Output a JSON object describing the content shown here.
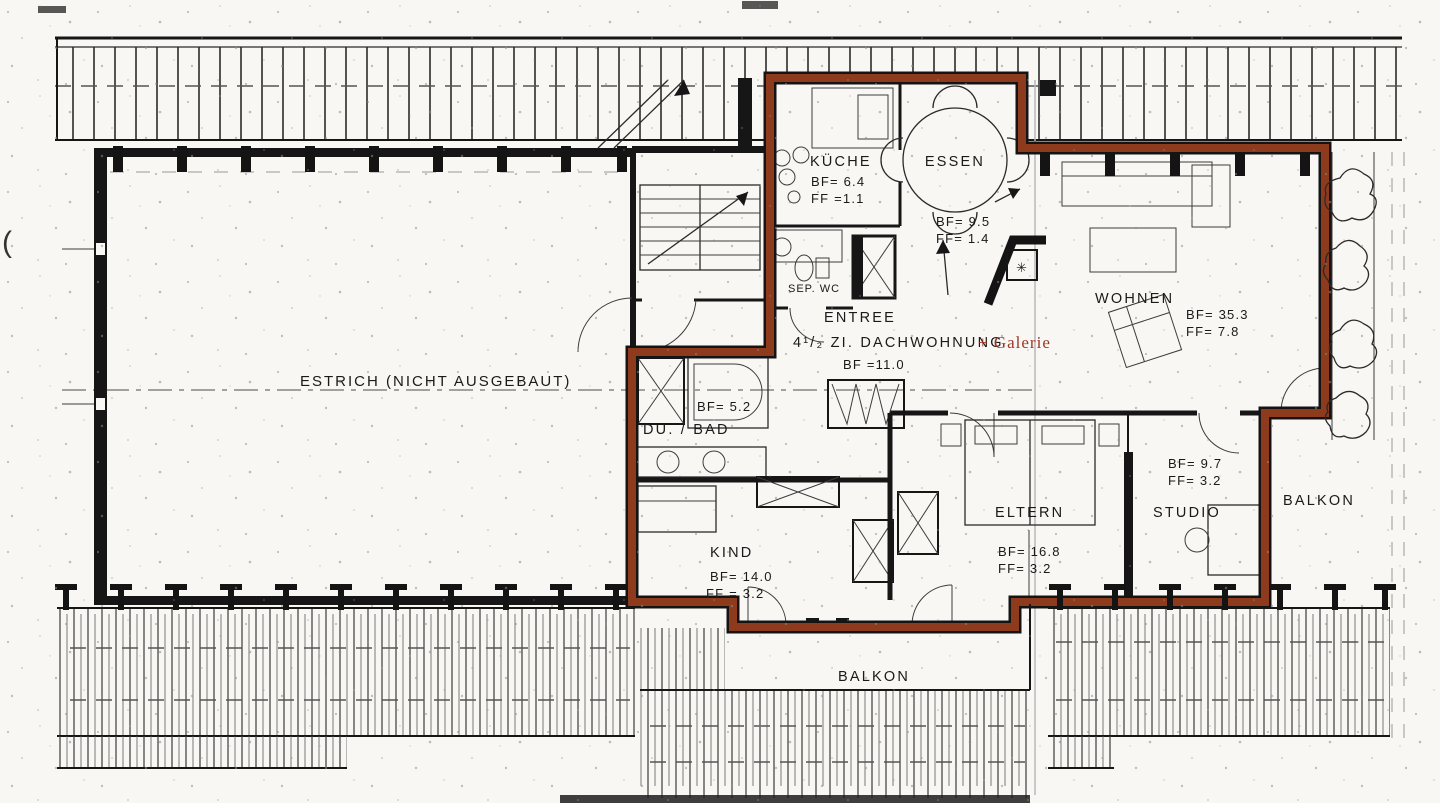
{
  "document": {
    "type": "scanned-floor-plan",
    "labels": {
      "estrich": "ESTRICH (NICHT AUSGEBAUT)",
      "entree": "ENTREE",
      "apartment_title": "4¹/₂ ZI. DACHWOHNUNG",
      "apartment_title_suffix": "+ Galerie",
      "apartment_bf": "BF =11.0",
      "sep_wc": "SEP. WC",
      "balkon_right": "BALKON",
      "balkon_bottom": "BALKON",
      "paren_artifact": "("
    },
    "rooms": {
      "kueche": {
        "name": "KÜCHE",
        "bf": "BF= 6.4",
        "ff": "FF =1.1"
      },
      "essen": {
        "name": "ESSEN",
        "bf": "BF= 9.5",
        "ff": "FF= 1.4"
      },
      "wohnen": {
        "name": "WOHNEN",
        "bf": "BF= 35.3",
        "ff": "FF=  7.8"
      },
      "du_bad": {
        "name": "DU. / BAD",
        "bf": "BF= 5.2"
      },
      "kind": {
        "name": "KIND",
        "bf": "BF= 14.0",
        "ff": "FF = 3.2"
      },
      "eltern": {
        "name": "ELTERN",
        "bf": "BF= 16.8",
        "ff": "FF= 3.2"
      },
      "studio": {
        "name": "STUDIO",
        "bf": "BF= 9.7",
        "ff": "FF= 3.2"
      }
    },
    "symbols": {
      "chimney_mark": "✳"
    },
    "colors": {
      "apartment_outline": "#8e3a1d",
      "galerie_text": "#9e3524",
      "ink": "#1a1a1a",
      "paper": "#f8f7f4"
    }
  }
}
